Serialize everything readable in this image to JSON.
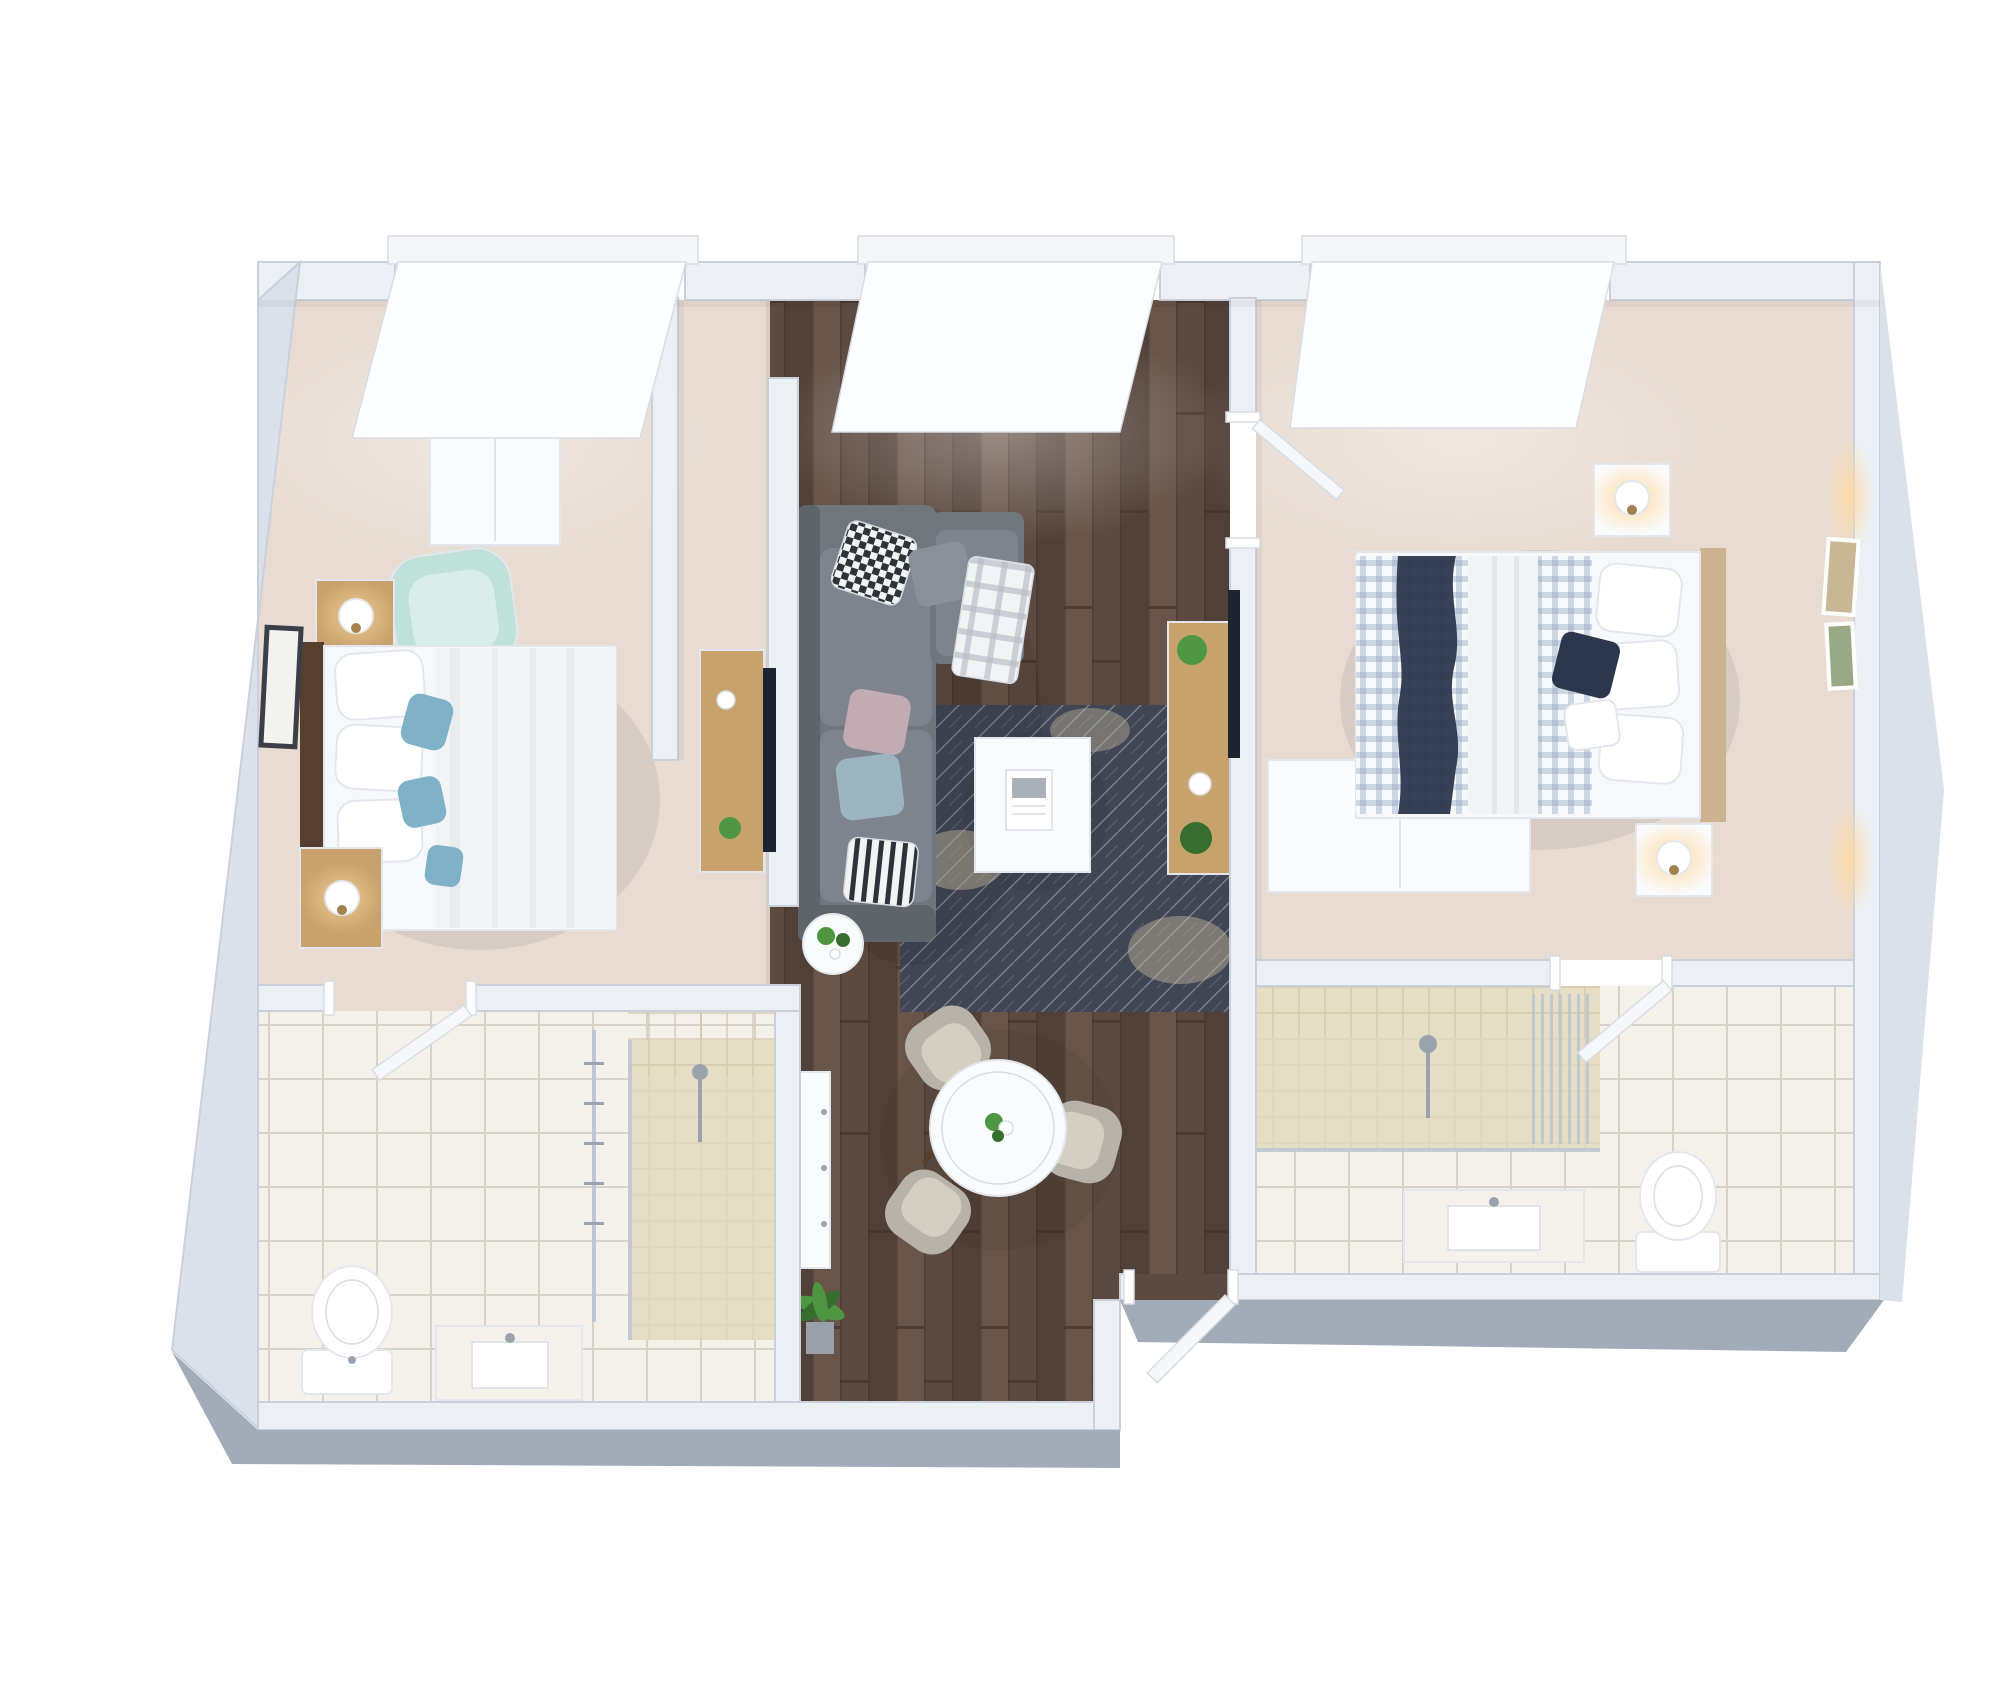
{
  "meta": {
    "content_type": "3d-floorplan-render",
    "view": "top-down perspective dollhouse render",
    "canvas_width": 2000,
    "canvas_height": 1700,
    "background": "#ffffff"
  },
  "colors": {
    "wall_top": "#ecf0f5",
    "wall_face": "#dbe1ea",
    "wall_outer": "#a2abb8",
    "wall_shadow": "#c9d0db",
    "window_glass": "#fdfeff",
    "window_sill": "#f4f6f9",
    "carpet": "#e8dcd2",
    "carpet_edge": "#d6ccc2",
    "wood_a": "#5c4a40",
    "wood_b": "#514037",
    "wood_c": "#685449",
    "wood_seam": "#42332b",
    "tile_base": "#f4f1eb",
    "tile_line": "#d8d3c8",
    "shower_base": "#e6ddc5",
    "shower_line": "#d3c9ae",
    "rug_base": "#404654",
    "rug_line": "#8a90a0",
    "rug_worn": "#c7bba0",
    "sofa_base": "#71767d",
    "sofa_cushion": "#7e848d",
    "sofa_dark": "#5f646b",
    "gray_pillow": "#8a9097",
    "white_furniture": "#fafbfd",
    "bed_white": "#f7f8fa",
    "blanket_white": "#f2f3f5",
    "oak": "#c8a26d",
    "oak_dark": "#a3824f",
    "dark_wood": "#573f2f",
    "headboard_oak": "#ccb28f",
    "mint": "#bfe1da",
    "mint_seat": "#daeee9",
    "teal": "#7fb2c7",
    "pink": "#c3abb4",
    "blue_pillow": "#9db5c1",
    "navy": "#2c374e",
    "gingham_line": "#8fa3c0",
    "plaid_line": "#b7bcc4",
    "checker_dark": "#2e3239",
    "chair_shell": "#b7b3a9",
    "chair_seat": "#d4cfc2",
    "plant": "#4f9642",
    "plant_dark": "#366f2d",
    "pot": "#99a0a8",
    "tv": "#1e2430",
    "glass": "#bac4d0",
    "metal": "#9aa3ad",
    "door": "#f5f7fa",
    "frame_dark": "#3b4048",
    "art_a": "#c8b694",
    "art_b": "#9aa985",
    "lamp_glow": "#ffd8a0",
    "magazine_line": "#aab0b8"
  },
  "scene": {
    "windows": 3,
    "entry_doors": 1,
    "interior_doors": 3,
    "rooms": [
      {
        "name": "bedroom-1",
        "floor": "beige carpet",
        "items": [
          "double bed with white duvet",
          "dark wood headboard",
          "white and teal pillows",
          "2 oak nightstands",
          "2 white sphere table lamps",
          "mint green armchair",
          "white wardrobe",
          "oak tv console with tv",
          "black framed wall art"
        ]
      },
      {
        "name": "living-dining",
        "floor": "dark hardwood planks",
        "items": [
          "gray L-shaped sectional sofa",
          "checkered and pastel throw pillows",
          "plaid throw blanket",
          "dark patterned area rug",
          "white coffee table with magazine",
          "round white side table with plants",
          "oak tv console with tv and plants",
          "round white dining table with flowers",
          "3 gray tub dining chairs",
          "slim white sideboard",
          "potted plant"
        ]
      },
      {
        "name": "bedroom-2",
        "floor": "beige carpet",
        "items": [
          "double bed with gingham duvet",
          "navy striped throw",
          "white folded blanket",
          "navy accent pillow",
          "2 white nightstands",
          "2 lit sphere table lamps",
          "white wardrobe",
          "2 art frames on wall"
        ]
      },
      {
        "name": "bathroom-1",
        "floor": "white tile",
        "items": [
          "walk-in shower with beige stone floor",
          "glass screen",
          "towel rail",
          "toilet",
          "sink vanity",
          "interior door"
        ]
      },
      {
        "name": "bathroom-2",
        "floor": "white tile",
        "items": [
          "walk-in shower with beige stone floor",
          "glass screen",
          "hand shower",
          "toilet",
          "sink vanity",
          "interior door"
        ]
      }
    ]
  }
}
